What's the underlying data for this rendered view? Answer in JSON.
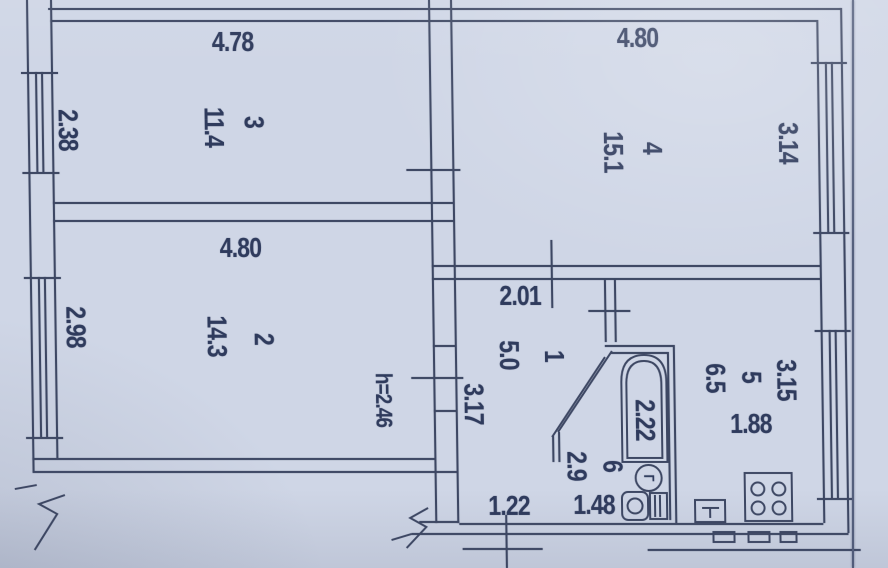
{
  "rooms": {
    "r3": {
      "number": "3",
      "area": "11.4",
      "width_m": "4.78",
      "depth_m": "2.38"
    },
    "r4": {
      "number": "4",
      "area": "15.1",
      "width_m": "4.80",
      "depth_m": "3.14"
    },
    "r2": {
      "number": "2",
      "area": "14.3",
      "width_m": "4.80",
      "depth_m": "2.98"
    },
    "r1": {
      "number": "1",
      "area": "5.0",
      "width_m": "2.01",
      "length_m": "3.17",
      "entry_width_m": "1.22"
    },
    "r5": {
      "number": "5",
      "area": "6.5",
      "depth_m": "3.15",
      "width_m": "1.88"
    },
    "r6": {
      "number": "6",
      "area": "2.9",
      "length_m": "2.22",
      "width_m": "1.48"
    }
  },
  "notes": {
    "ceiling_height": "h=2.46"
  },
  "fixtures": {
    "water_heater_symbol": "Г"
  },
  "colors": {
    "paper": "#cfd6e6",
    "ink": "#3d4763"
  }
}
